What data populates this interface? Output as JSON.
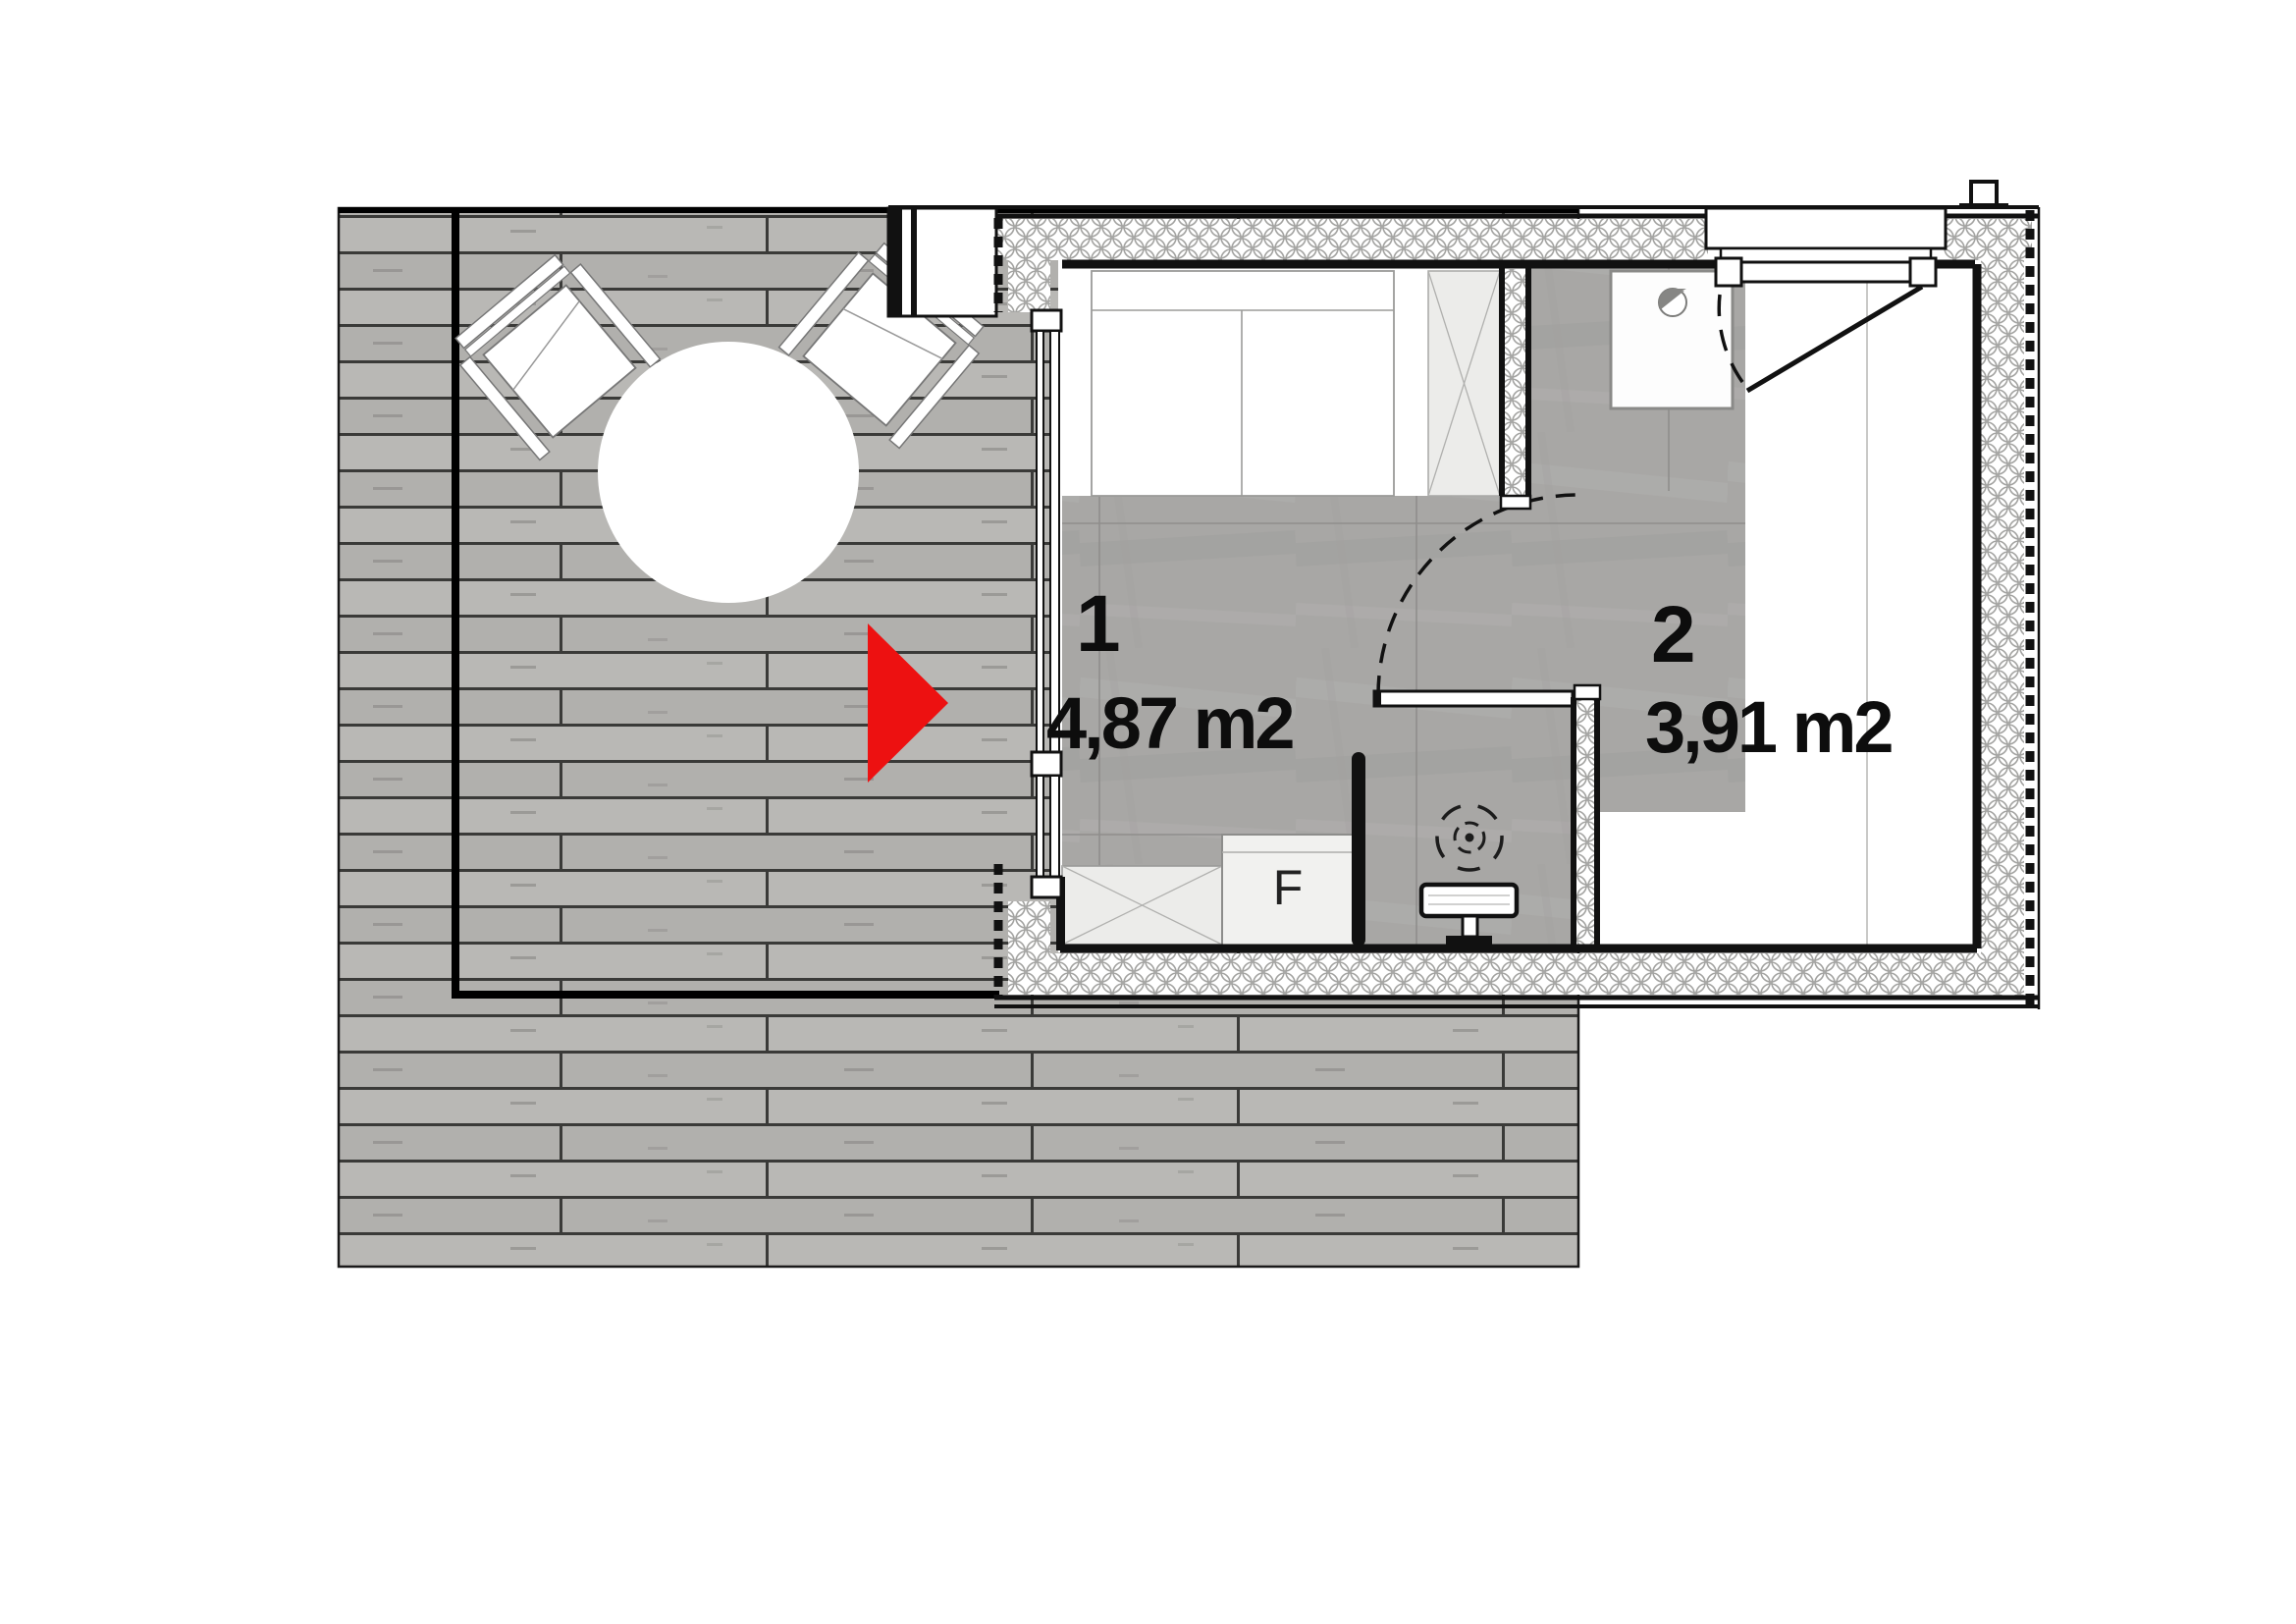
{
  "page": {
    "background": "#ffffff",
    "type": "architectural-floor-plan"
  },
  "plan": {
    "rooms": [
      {
        "number": "1",
        "area": "4,87 m2"
      },
      {
        "number": "2",
        "area": "3,91 m2"
      }
    ],
    "fridge_label": "F",
    "colors": {
      "arrow_red": "#ed1111",
      "deck_plank_light": "#b9b8b5",
      "deck_plank_dark": "#b1b0ad",
      "plank_joint": "#3a3a38",
      "concrete_floor": "#a8a7a5",
      "wall_black": "#111111",
      "insulation_stroke": "#a3a3a1"
    },
    "icons": {
      "entrance_arrow": "entrance-arrow-icon",
      "shower_drain": "shower-drain-icon",
      "floor_drain": "floor-drain-icon",
      "roof_vent": "roof-vent-icon"
    }
  }
}
